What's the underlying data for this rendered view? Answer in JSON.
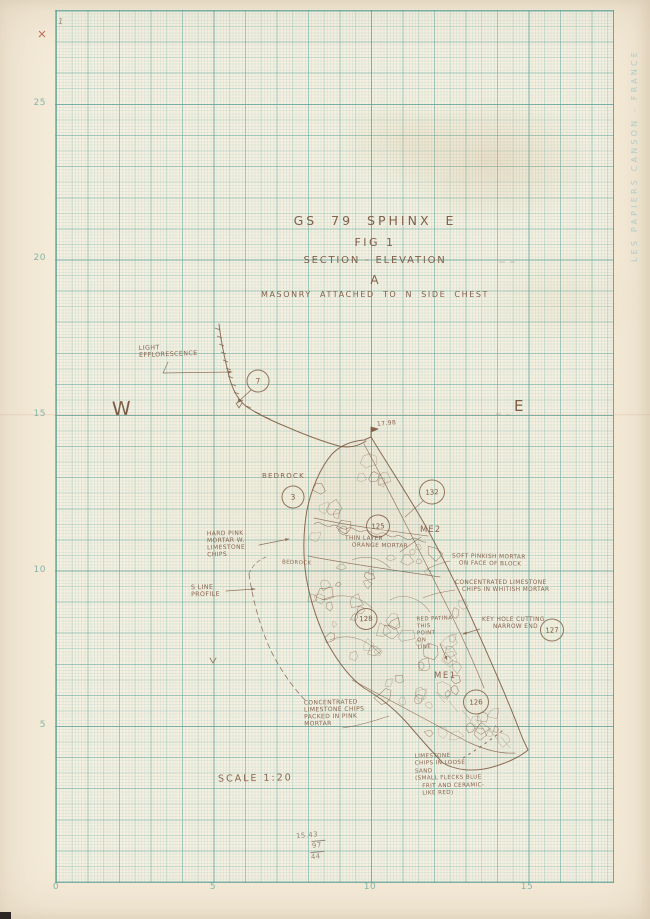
{
  "sheet": {
    "brand_text": "LES PAPIERS CANSON - FRANCE",
    "page_mark": "1"
  },
  "axes": {
    "left": [
      "25",
      "20",
      "15",
      "10",
      "5"
    ],
    "bottom": [
      "0",
      "5",
      "10",
      "15"
    ]
  },
  "title": {
    "line1": "GS 79  SPHINX  E",
    "line2": "FIG 1",
    "line3": "SECTION - ELEVATION",
    "line4": "A",
    "line5": "MASONRY  ATTACHED  TO  N  SIDE  CHEST"
  },
  "directions": {
    "west": "W",
    "east": "E"
  },
  "marks": {
    "elevation": "17.98",
    "scale": "SCALE  1:20"
  },
  "circles": {
    "c7": "7",
    "c3": "3",
    "c132": "132",
    "c125": "125",
    "c128": "128",
    "c127": "127",
    "c126": "126"
  },
  "zones": {
    "me2": "ME2",
    "me1": "ME1"
  },
  "ann": {
    "light_efflorescence": [
      "LIGHT",
      "EFFLORESCENCE"
    ],
    "bedrock": "BEDROCK",
    "bedrock_small": "BEDROCK",
    "pink_mortar": [
      "HARD PINK",
      "MORTAR W.",
      "LIMESTONE",
      "CHIPS"
    ],
    "s_line": [
      "S LINE",
      "PROFILE"
    ],
    "thin_layer": [
      "THIN LAYER",
      "ORANGE MORTAR"
    ],
    "soft_pinkish": [
      "SOFT PINKISH MORTAR",
      "ON FACE OF BLOCK"
    ],
    "conc_whitish": [
      "CONCENTRATED LIMESTONE",
      "CHIPS IN WHITISH MORTAR"
    ],
    "red_patina": [
      "RED PATINA",
      "THIS",
      "POINT",
      "ON",
      "LINE"
    ],
    "keyhole": [
      "KEY HOLE CUTTING",
      "NARROW END"
    ],
    "conc_pink": [
      "CONCENTRATED",
      "LIMESTONE CHIPS",
      "PACKED IN PINK",
      "MORTAR"
    ],
    "loose_sand": [
      "LIMESTONE",
      "CHIPS IN LOOSE",
      "SAND",
      "(SMALL FLECKS BLUE",
      "FRIT AND CERAMIC-",
      "LIKE RED)"
    ]
  },
  "calc": {
    "top": "15.43",
    "mid": "97",
    "bot": "44"
  },
  "colors": {
    "ink": "#7a5740",
    "hand_text": "#8a6550",
    "grid_print": "#7fb3a9",
    "pencil": "#958a7b",
    "red_mark": "#b5483a",
    "paper": "#f4ebd8"
  }
}
